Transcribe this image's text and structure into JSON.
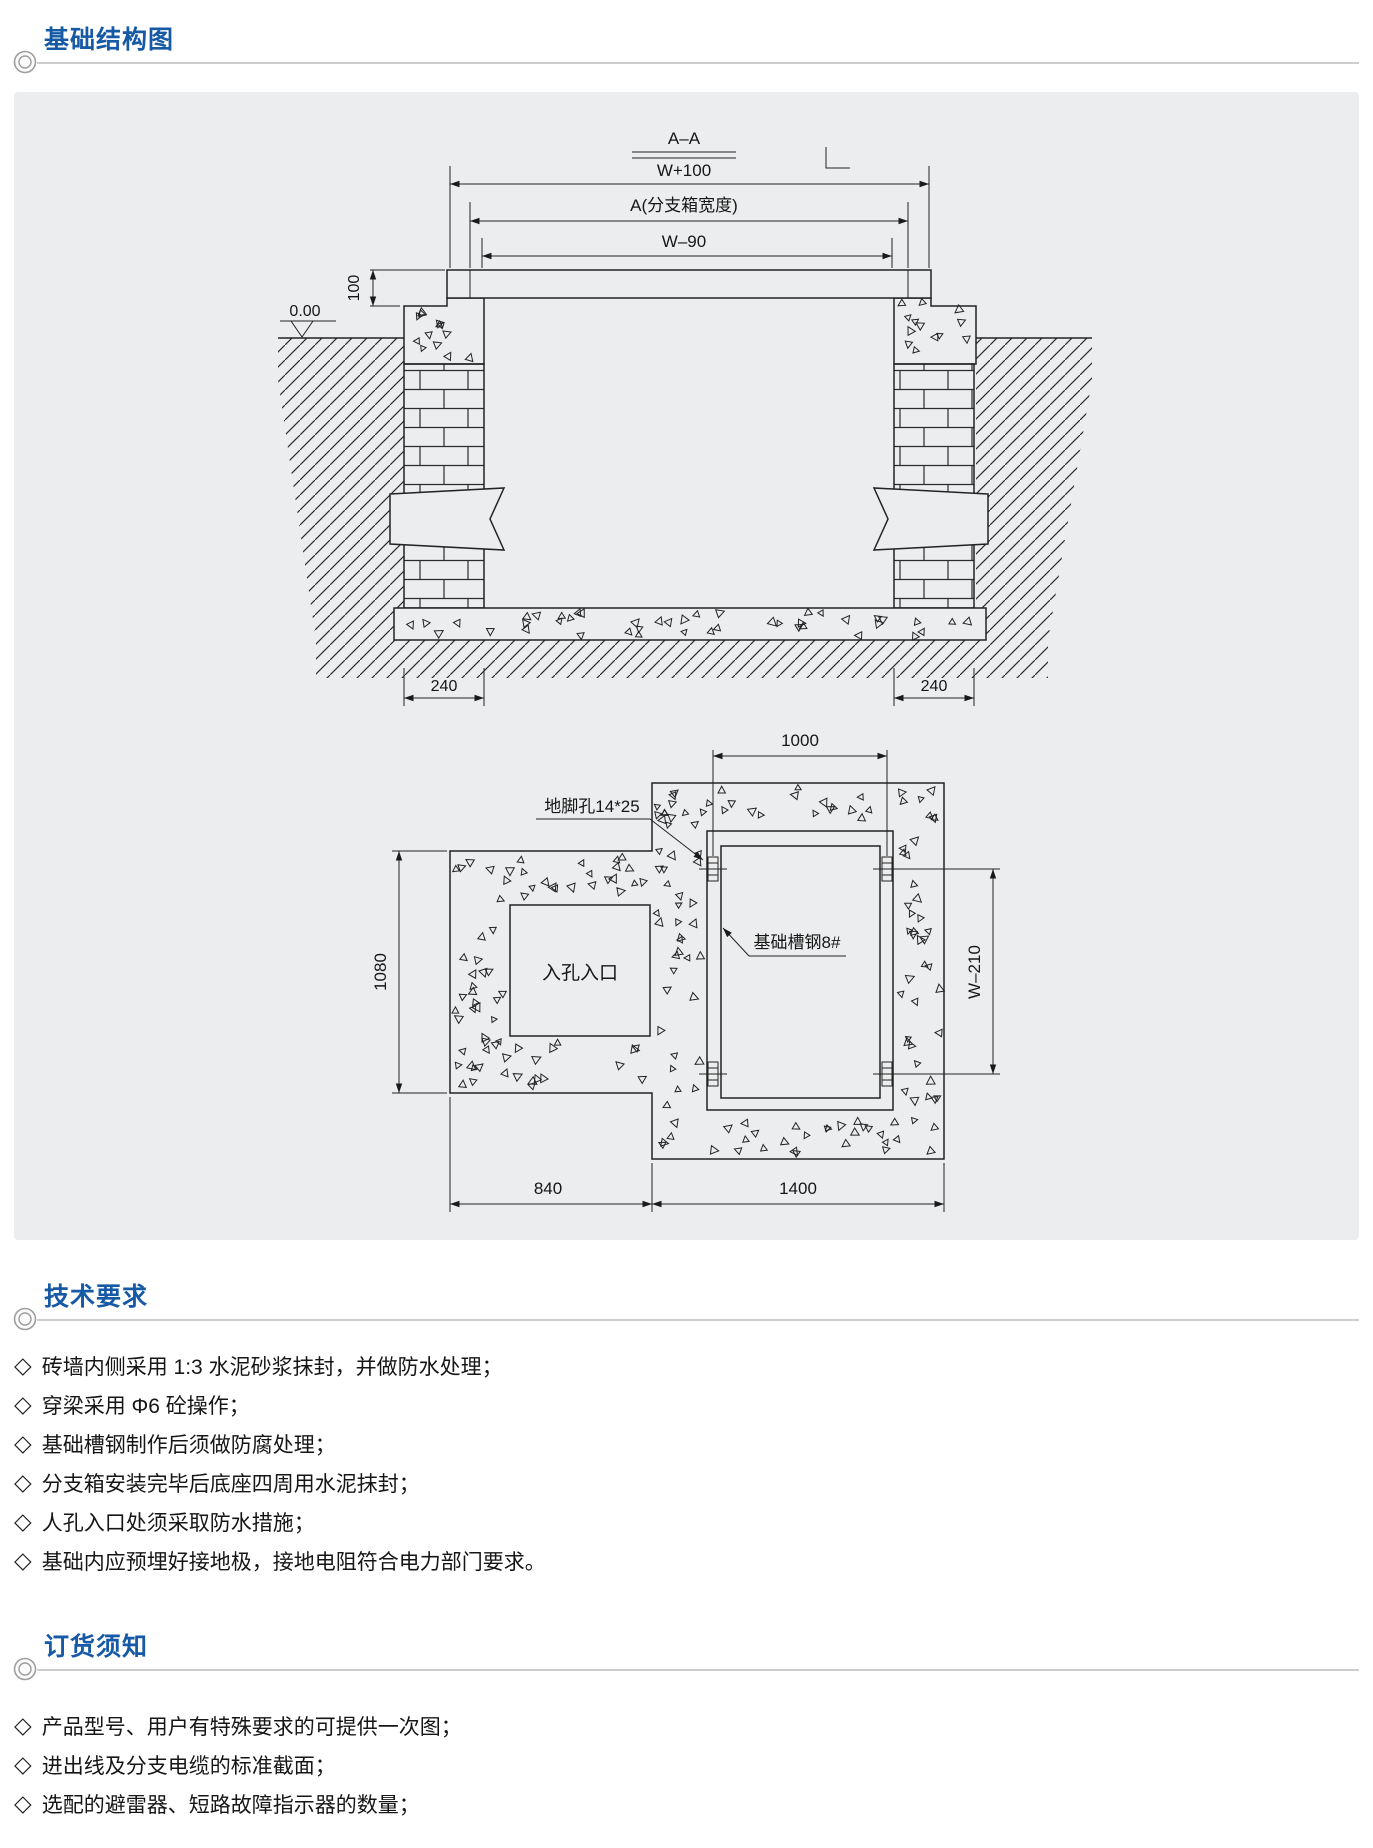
{
  "sections": {
    "structure": {
      "title": "基础结构图"
    },
    "tech": {
      "title": "技术要求",
      "items": [
        "砖墙内侧采用 1:3 水泥砂浆抹封，并做防水处理；",
        "穿梁采用 Φ6 砼操作；",
        "基础槽钢制作后须做防腐处理；",
        "分支箱安装完毕后底座四周用水泥抹封；",
        "人孔入口处须采取防水措施；",
        "基础内应预埋好接地极，接地电阻符合电力部门要求。"
      ]
    },
    "order": {
      "title": "订货须知",
      "items": [
        "产品型号、用户有特殊要求的可提供一次图；",
        "进出线及分支电缆的标准截面；",
        "选配的避雷器、短路故障指示器的数量；"
      ]
    }
  },
  "bullets": {
    "marker": "◇"
  },
  "colors": {
    "heading_blue": "#1659a5",
    "panel_gray": "#ecedee",
    "rule_gray": "#cdcdcd",
    "ink": "#1a1a1a"
  },
  "diagram": {
    "section_view": {
      "title": "A–A",
      "dim_w_plus_100": "W+100",
      "dim_box_width": "A(分支箱宽度)",
      "dim_w_minus_90": "W–90",
      "dim_cover_thickness": "100",
      "level_mark": "0.00",
      "dim_wall_left": "240",
      "dim_wall_right": "240"
    },
    "plan_view": {
      "dim_bolt_spacing": "1000",
      "dim_pit_height": "1080",
      "dim_w_minus_210": "W–210",
      "dim_bottom_left": "840",
      "dim_bottom_right": "1400",
      "label_anchor_hole": "地脚孔14*25",
      "label_channel_steel": "基础槽钢8#",
      "label_manhole": "入孔入口"
    }
  }
}
